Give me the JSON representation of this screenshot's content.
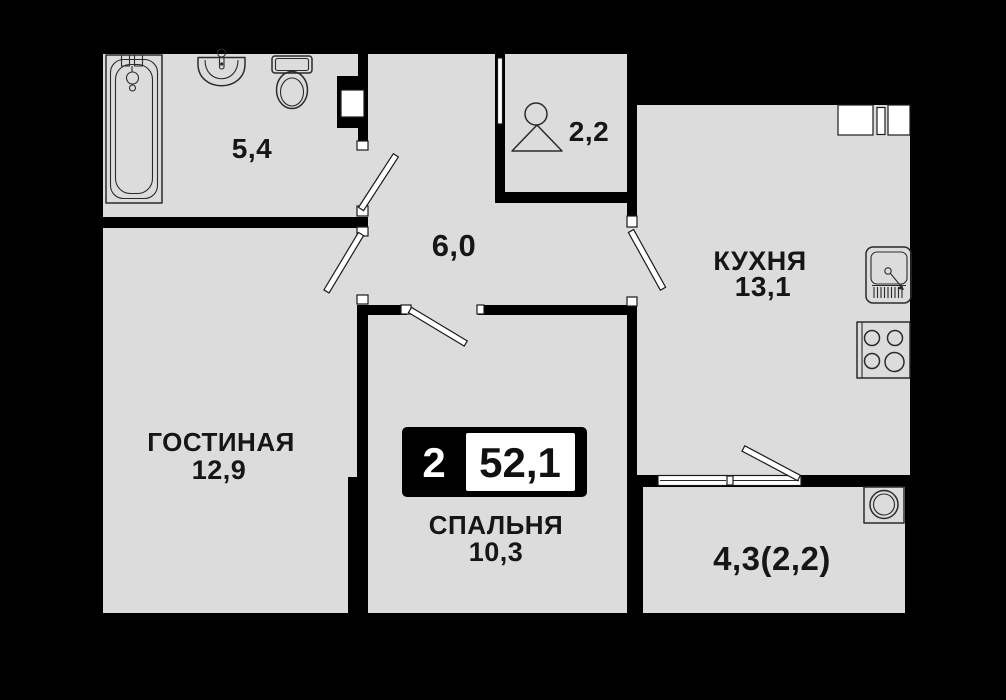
{
  "plan": {
    "title": "apartment-floor-plan",
    "badge": {
      "rooms_count": "2",
      "total_area": "52,1"
    },
    "rooms": {
      "bathroom": {
        "area": "5,4"
      },
      "hallway": {
        "area": "6,0"
      },
      "wardrobe": {
        "area": "2,2"
      },
      "kitchen": {
        "name": "КУХНЯ",
        "area": "13,1"
      },
      "living": {
        "name": "ГОСТИНАЯ",
        "area": "12,9"
      },
      "bedroom": {
        "name": "СПАЛЬНЯ",
        "area": "10,3"
      },
      "balcony": {
        "area": "4,3(2,2)"
      }
    },
    "icons": [
      "bathtub-icon",
      "bathroom-sink-icon",
      "toilet-icon",
      "hanger-icon",
      "kitchen-sink-icon",
      "stove-icon",
      "washing-machine-icon",
      "vent-shaft-icon",
      "door-leaf-icon",
      "window-icon"
    ],
    "colors": {
      "background": "#000000",
      "wall": "#000000",
      "floor": "#dcdcdc",
      "fixture_stroke": "#2b2b2b",
      "text": "#161616",
      "badge_bg": "#000000",
      "badge_box": "#ffffff"
    }
  }
}
